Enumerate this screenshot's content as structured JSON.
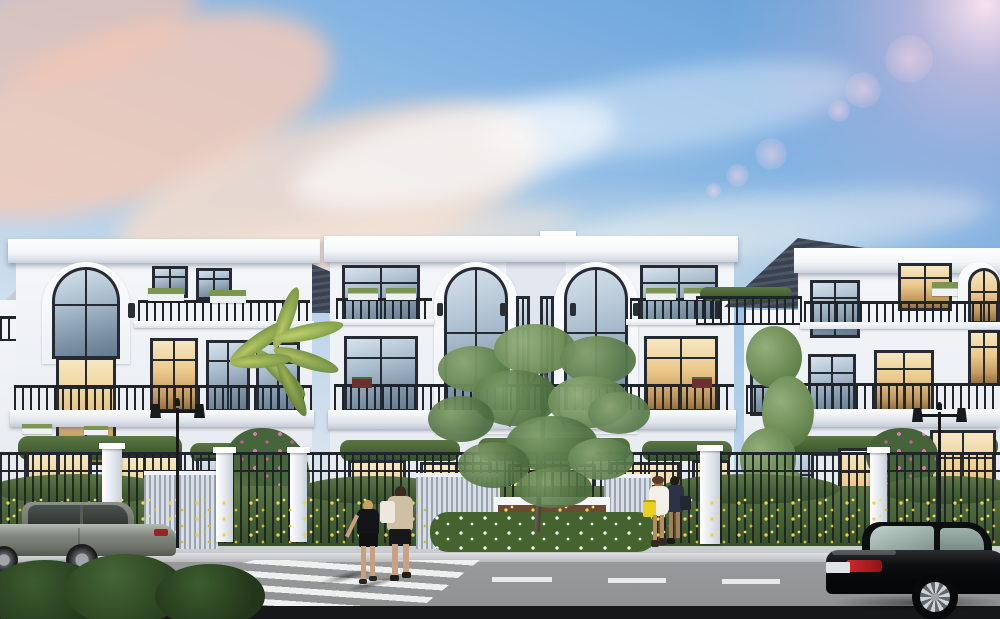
{
  "scene": {
    "setting": "Architectural rendering of a row of three-story white neoclassical villas with dark hip roofs, seen from across a street at dusk",
    "sky": "clear dusk sky, blue above with pink-cream cloud band on the left and a pink sun lens flare with bokeh in the top right corner",
    "counts": {
      "villas": 3,
      "cars": 2,
      "pedestrians": 4,
      "street_lamps": 2,
      "crosswalks": 1,
      "lane_dashes": 3
    },
    "objects": {
      "villa_left": "white villa with arched feature window, roof terrace railing, planter boxes and warm lit interiors",
      "villa_center": "symmetric twin villa with two double-height arched windows flanking a recessed bay topped by a small dark gable",
      "villa_right": "white villa with dark hip roof, balconies, golden lit arched corner windows",
      "fence": "black metal picket fence with white masonry posts, light slatted gates and a central planter wall",
      "landscaping": "yellow flower beds along the fence, white flower hedge at the center planter, pink bougainvillea shrubs, a palm and two shade trees",
      "street": "gray asphalt road with white zebra crosswalk, dashed lane markings, granite sidewalk and curb",
      "car_gray": "gray sedan parked at the left curb facing left",
      "car_black": "black coupe with red taillights and silver alloy wheel at the right, moving right",
      "pedestrians_crossing": "young couple seen from behind crossing on the zebra crossing, man with white tote bag, woman in black",
      "pedestrians_sidewalk": "two women walking left along the sidewalk, one in a white dress with a yellow handbag, one in dark navy"
    }
  },
  "palette": {
    "sky_top": "#5f9cd3",
    "sky_horizon": "#f0ece2",
    "cloud_pink": "#f6d3bd",
    "facade": "#e9edf2",
    "roof": "#3a4250",
    "frame": "#262b33",
    "glass_cool": "#a9bccd",
    "glass_warm": "#ecc98b",
    "railing": "#20252c",
    "foliage": "#36502a",
    "flower_yellow": "#eed63e",
    "flower_pink": "#d678a8",
    "road": "#8f9193",
    "sidewalk": "#c7cacc",
    "marking": "#eff1f2",
    "car_gray": "#7f857d",
    "car_black": "#0d0e10"
  }
}
